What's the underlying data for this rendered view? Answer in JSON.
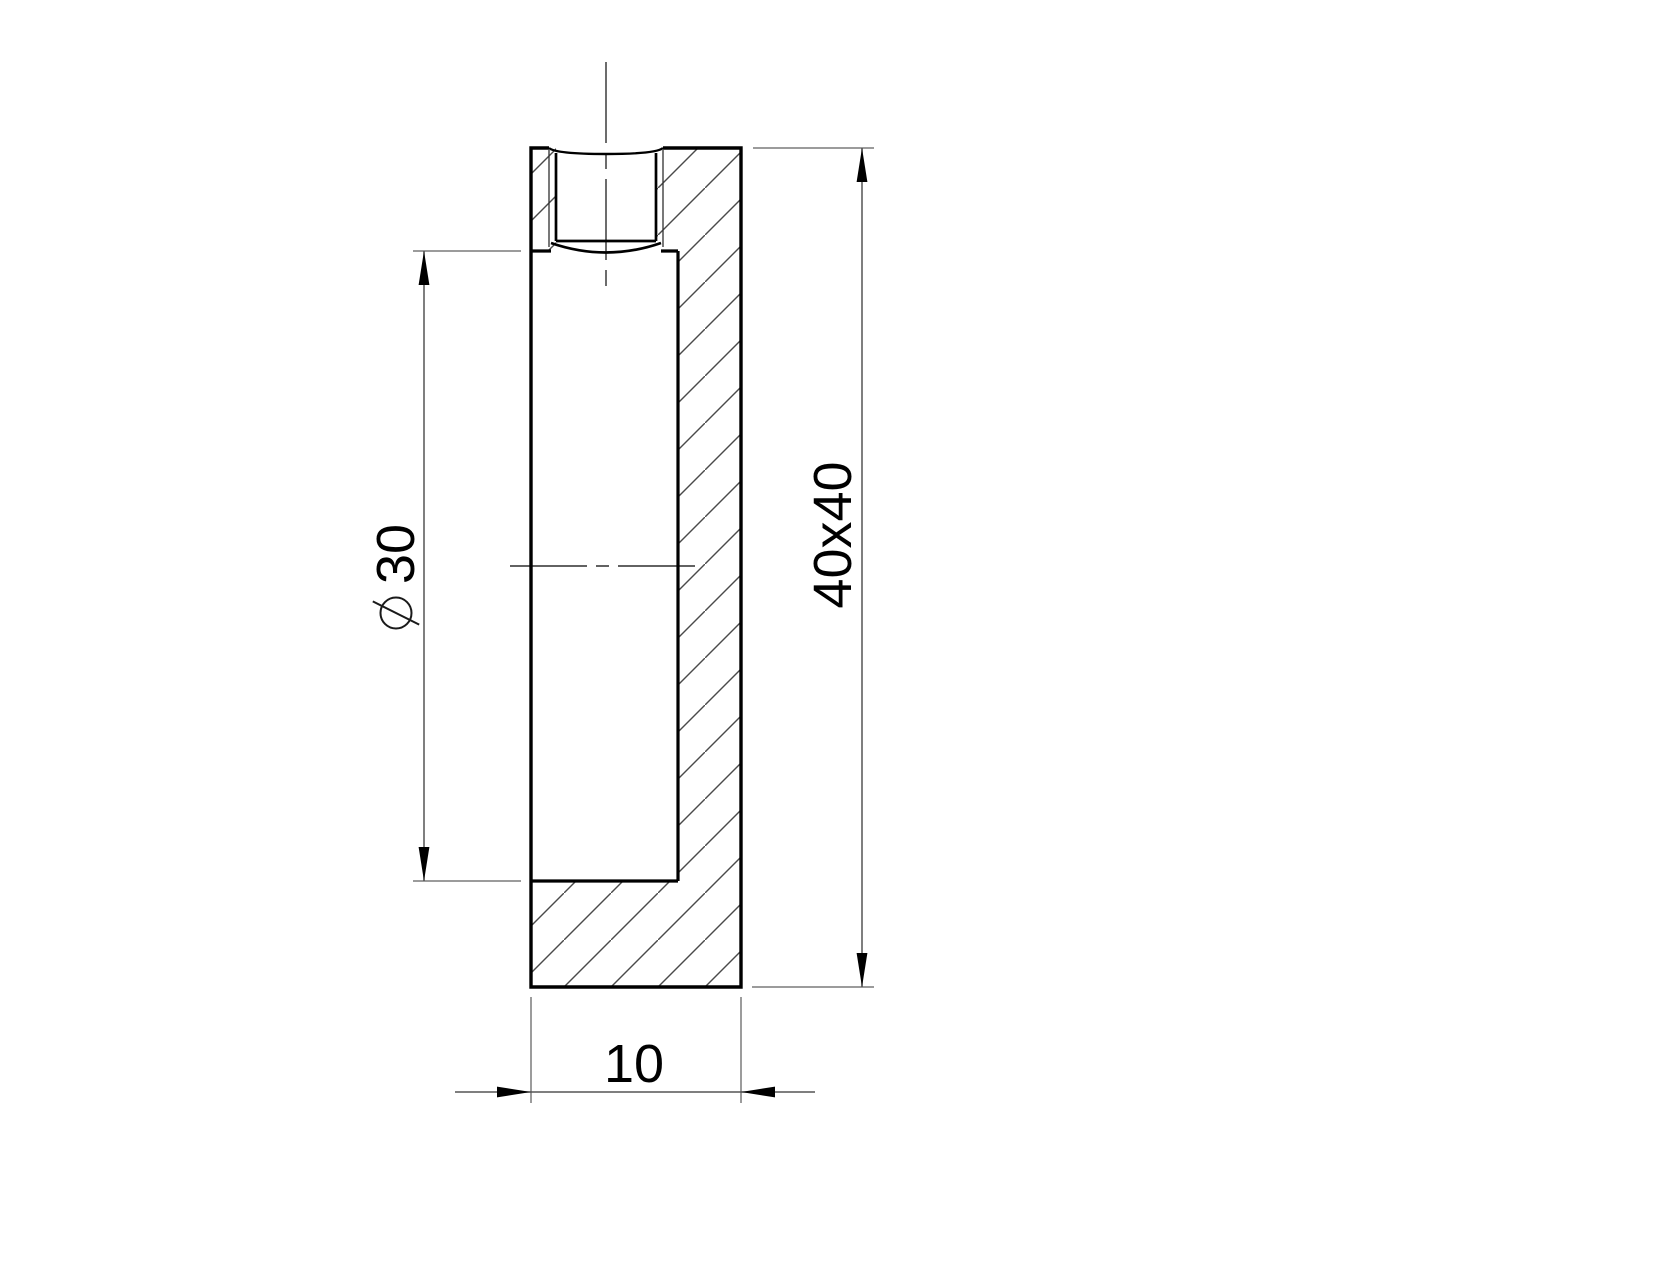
{
  "drawing": {
    "colors": {
      "background": "#ffffff",
      "outline": "#000000",
      "thin_line": "#303030",
      "hatch": "#4a4a4a",
      "dimension_line": "#555555",
      "extension_line": "#7a7a7a",
      "centerline": "#2e2e2e",
      "arrow": "#000000",
      "text": "#000000"
    },
    "dimensions": {
      "bore_diameter": {
        "symbol": "⌀",
        "value": "30",
        "label": "⌀30"
      },
      "profile_size": {
        "label": "40x40"
      },
      "thickness": {
        "label": "10"
      }
    }
  }
}
